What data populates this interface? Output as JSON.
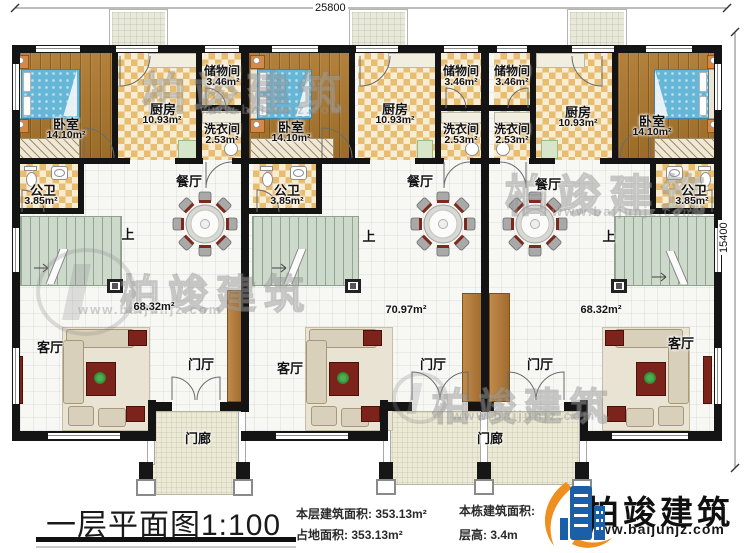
{
  "dimensions": {
    "top": "25800",
    "right": "15400"
  },
  "rooms": {
    "bedroom": {
      "label": "卧室",
      "area": "14.10m²"
    },
    "kitchen": {
      "label": "厨房",
      "area": "10.93m²"
    },
    "storage": {
      "label": "储物间",
      "area": "3.46m²"
    },
    "laundry": {
      "label": "洗衣间",
      "area": "2.53m²"
    },
    "bathroom": {
      "label": "公卫",
      "area": "3.85m²"
    },
    "dining": {
      "label": "餐厅"
    },
    "living": {
      "label": "客厅"
    },
    "foyer": {
      "label": "门厅"
    },
    "porch": {
      "label": "门廊"
    },
    "stairs_up": {
      "label": "上"
    }
  },
  "unit_areas": {
    "left": "68.32m²",
    "middle": "70.97m²",
    "right": "68.32m²"
  },
  "title_block": {
    "title": "一层平面图1:100",
    "stats": [
      {
        "label": "本层建筑面积: ",
        "value": "353.13m²"
      },
      {
        "label": "占地面积: ",
        "value": "353.13m²"
      },
      {
        "label": "本栋建筑面积: ",
        "value": ""
      },
      {
        "label": "层高: ",
        "value": "3.4m"
      }
    ],
    "brand": {
      "name": "柏竣建筑",
      "url": "www.baijunjz.com"
    }
  },
  "watermark": {
    "name": "柏竣建筑",
    "url": "www.baijunjz.com"
  }
}
